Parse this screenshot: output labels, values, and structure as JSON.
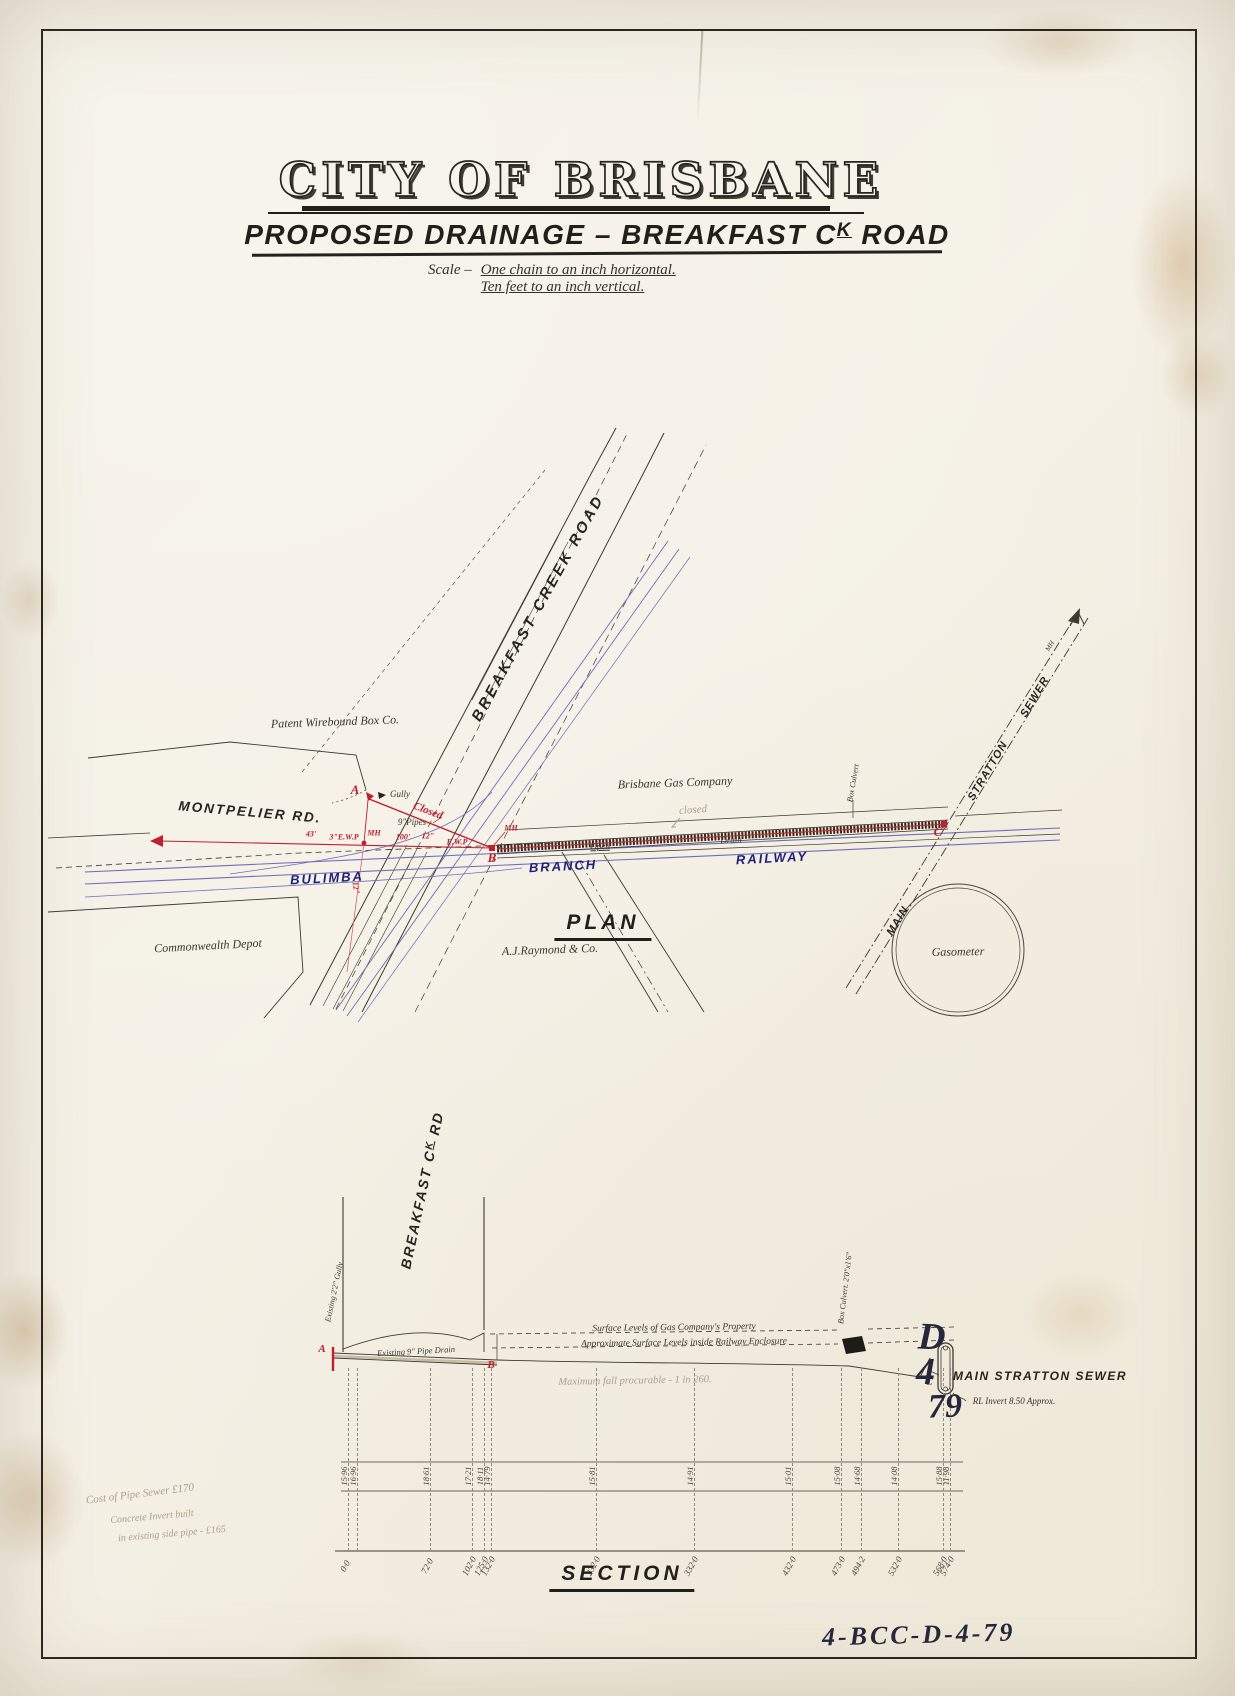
{
  "sheet": {
    "title": "CITY OF BRISBANE",
    "subtitle_part1": "PROPOSED  DRAINAGE  –  BREAKFAST  C",
    "subtitle_sup": "K",
    "subtitle_part2": " ROAD",
    "scale_prefix": "Scale –",
    "scale_line1": "One chain to an inch horizontal.",
    "scale_line2": "Ten feet to an inch vertical."
  },
  "plan": {
    "label": "PLAN",
    "breakfast_creek_road": "BREAKFAST  CREEK  ROAD",
    "montpelier_rd": "MONTPELIER  RD.",
    "railway_word1": "BULIMBA",
    "railway_word2": "BRANCH",
    "railway_word3": "RAILWAY",
    "sewer_word1": "MAIN",
    "sewer_word2": "STRATTON",
    "sewer_word3": "SEWER",
    "sewer_mh": "MH",
    "patent_box_co": "Patent  Wirebound  Box  Co.",
    "brisbane_gas": "Brisbane  Gas  Company",
    "commonwealth_depot": "Commonwealth  Depot",
    "aj_raymond": "A.J.Raymond & Co.",
    "gasometer": "Gasometer",
    "point_a": "A",
    "point_b": "B",
    "point_c": "C",
    "gully": "Gully",
    "closed": "Closed",
    "pipes_9": "9\"Pipes",
    "dim_43": "43'",
    "ewp_3": "3\"E.W.P",
    "mh1": "MH",
    "dim_100": "100'",
    "dim_12": "12\"",
    "ewp": "E.W.P",
    "mh_b": "MH",
    "pipe_12_vert": "12\"",
    "open_label": "Open",
    "drain_label": "Drain",
    "box_culvert": "Box Culvert",
    "closed_pencil": "closed"
  },
  "section": {
    "label": "SECTION",
    "road_part1": "BREAKFAST  C",
    "road_sup": "K",
    "road_part2": " RD",
    "gully": "Existing 2'2\" Gully",
    "pipe_drain": "Existing 9\" Pipe Drain",
    "surface_gas": "Surface Levels of Gas Company's Property",
    "surface_rail": "Approximate Surface Levels inside Railway Enclosure",
    "fall_note": "Maximum fall procurable  -  1 in 260.",
    "box_culvert": "Box Culvert. 2'0\"x1'6\"",
    "sewer": "MAIN STRATTON SEWER",
    "invert": "RL Invert  8.50 Approx.",
    "point_a": "A",
    "point_b": "B",
    "point_c": "C",
    "ordinates": [
      {
        "px": 348,
        "level": "15·96",
        "chainage": "0·0"
      },
      {
        "px": 357,
        "level": "16·96",
        "chainage": ""
      },
      {
        "px": 430,
        "level": "18·61",
        "chainage": "72·0"
      },
      {
        "px": 472,
        "level": "17·21",
        "chainage": "102·0"
      },
      {
        "px": 484,
        "level": "18·11",
        "chainage": "125·0"
      },
      {
        "px": 491,
        "level": "14·79",
        "chainage": "132·0"
      },
      {
        "px": 596,
        "level": "15·81",
        "chainage": "232·0"
      },
      {
        "px": 694,
        "level": "14·91",
        "chainage": "332·0"
      },
      {
        "px": 792,
        "level": "15·01",
        "chainage": "432·0"
      },
      {
        "px": 841,
        "level": "15·08",
        "chainage": "473·0"
      },
      {
        "px": 861,
        "level": "14·68",
        "chainage": "494·2"
      },
      {
        "px": 898,
        "level": "14·08",
        "chainage": "532·0"
      },
      {
        "px": 943,
        "level": "15·88",
        "chainage": "568·0"
      },
      {
        "px": 950,
        "level": "11·98",
        "chainage": "574·0"
      }
    ]
  },
  "stamps": {
    "d": "D",
    "four": "4",
    "seven_nine": "79",
    "ref": "4-BCC-D-4-79"
  },
  "pencil": {
    "cost1": "Cost of Pipe Sewer £170",
    "cost2": "Concrete Invert built",
    "cost3": "in existing side pipe - £165"
  }
}
